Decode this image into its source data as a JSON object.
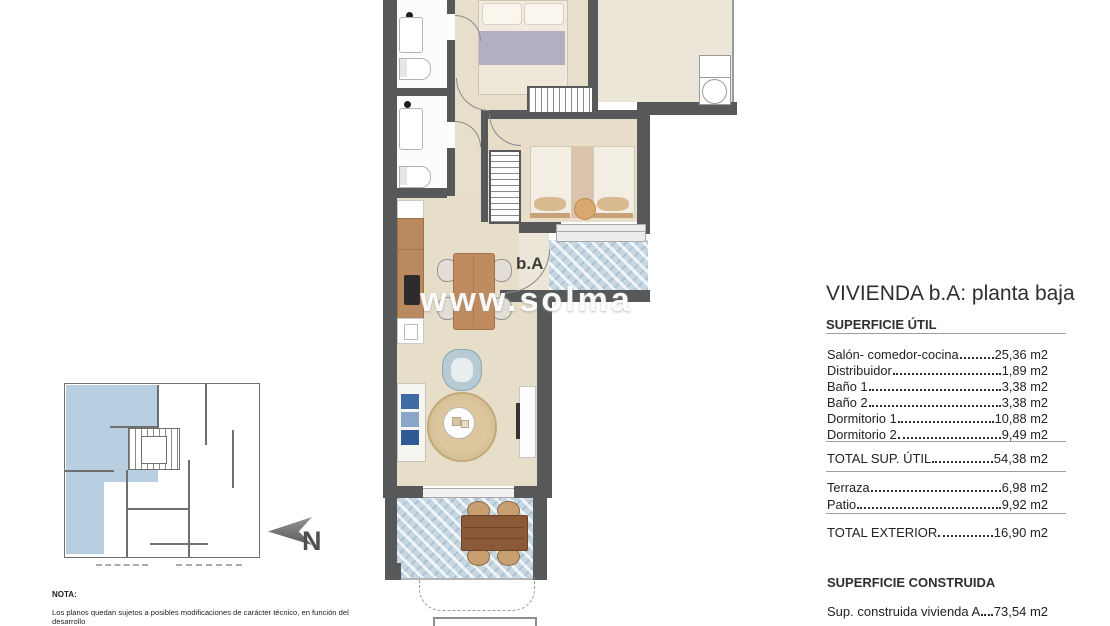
{
  "watermark": {
    "text": "www.solma"
  },
  "plan": {
    "unit_label": "b.A"
  },
  "mini_map": {
    "north_label": "N"
  },
  "details": {
    "title": "VIVIENDA b.A: planta baja",
    "superficie_util_heading": "SUPERFICIE ÚTIL",
    "util_rows": [
      {
        "label": "Salón- comedor-cocina",
        "value": "25,36 m2"
      },
      {
        "label": "Distribuidor",
        "value": "1,89 m2"
      },
      {
        "label": "Baño 1",
        "value": "3,38 m2"
      },
      {
        "label": "Baño 2",
        "value": "3,38 m2"
      },
      {
        "label": "Dormitorio 1",
        "value": "10,88 m2"
      },
      {
        "label": "Dormitorio 2",
        "value": "9,49 m2"
      }
    ],
    "total_util": {
      "label": "TOTAL SUP. ÚTIL",
      "value": "54,38 m2"
    },
    "exterior_rows": [
      {
        "label": "Terraza",
        "value": "6,98 m2"
      },
      {
        "label": "Patio",
        "value": "9,92 m2"
      }
    ],
    "total_exterior": {
      "label": "TOTAL EXTERIOR",
      "value": "16,90 m2"
    },
    "construida_heading": "SUPERFICIE CONSTRUIDA",
    "construida_row": {
      "label": "Sup. construida vivienda A",
      "value": "73,54 m2"
    }
  },
  "note": {
    "heading": "NOTA:",
    "line1": "Los planos quedan sujetos a posibles modificaciones de carácter técnico, en función del desarrollo",
    "line2": "del proyecto y de la obra, según indicaciones de la dirección facultativa. El amueblamiento reflejado"
  },
  "colors": {
    "wall": "#57585a",
    "floor_beige": "#e7dfcb",
    "outdoor_tile": "#c6d7e2",
    "keyplan_highlight": "#b7cfe1",
    "wood": "#bc8e62"
  }
}
